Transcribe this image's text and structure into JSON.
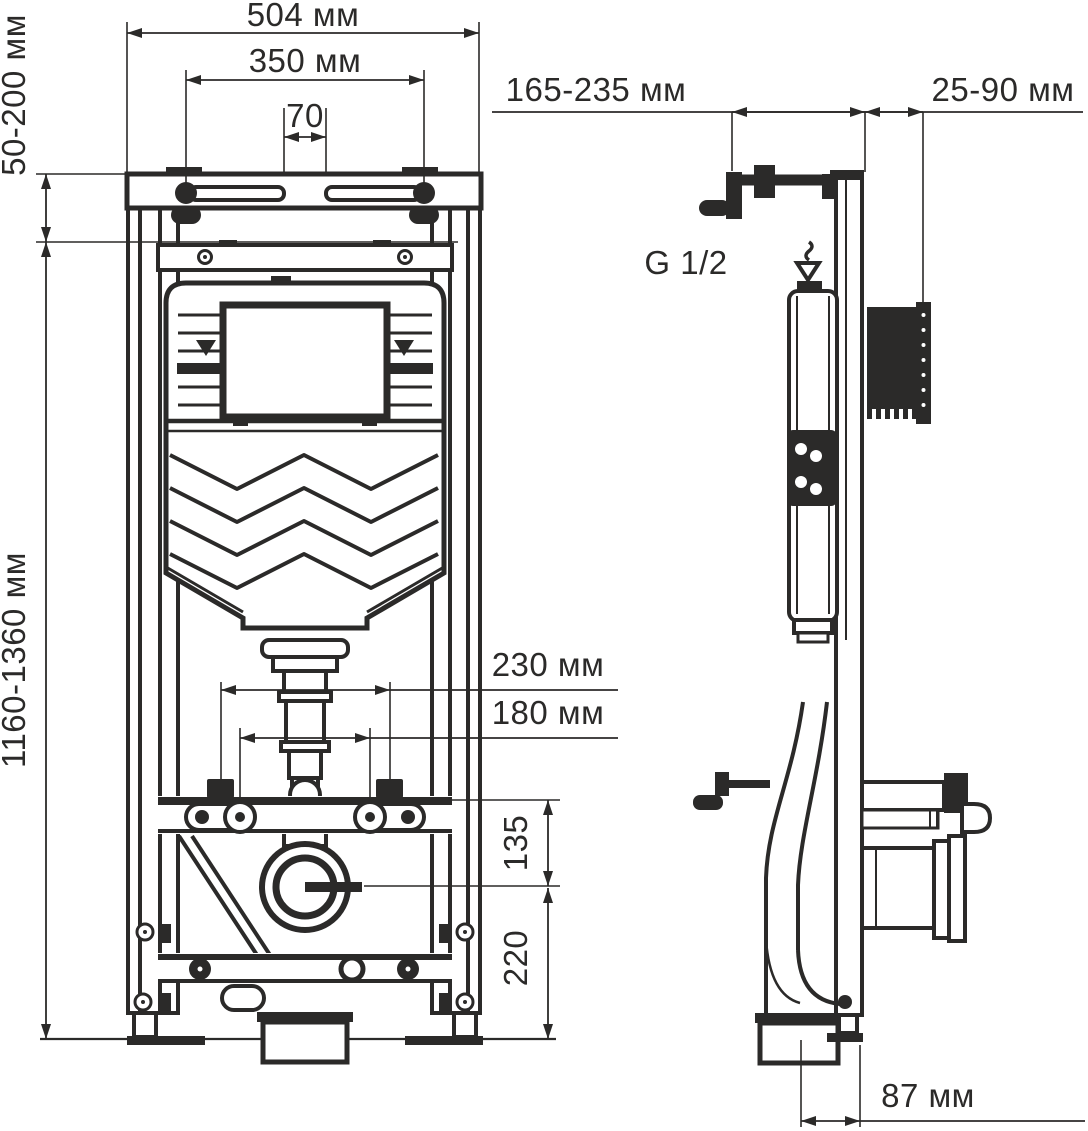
{
  "labels": {
    "front": {
      "overall_width": "504 мм",
      "bolt_spacing": "350 мм",
      "slot_gap": "70",
      "top_adjust": "50-200 мм",
      "height_range": "1160-1360 мм",
      "plug_spacing": "230 мм",
      "stud_spacing": "180 мм",
      "outlet_to_studs": "135",
      "outlet_height": "220"
    },
    "side": {
      "inlet_depth": "165-235 мм",
      "wall_gap": "25-90 мм",
      "outlet_offset": "87 мм",
      "water_thread": "G 1/2"
    }
  },
  "colors": {
    "ink": "#2b2a29",
    "background": "#ffffff"
  }
}
